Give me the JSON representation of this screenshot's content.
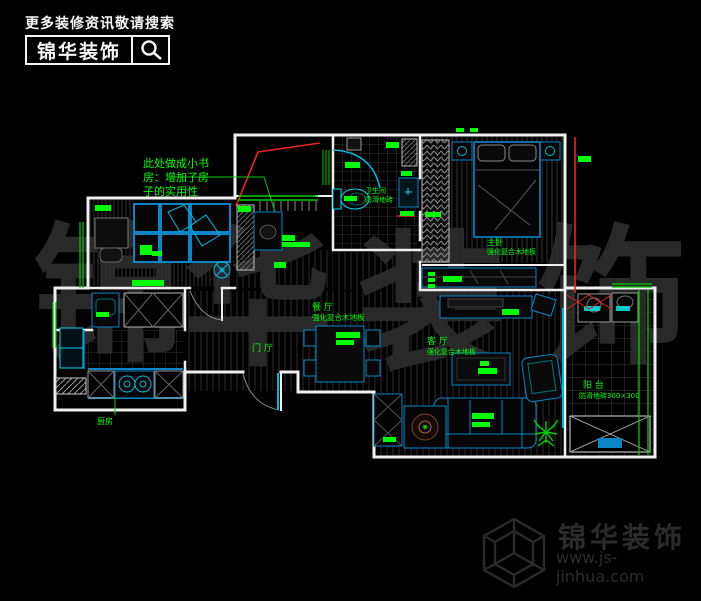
{
  "header": {
    "tagline": "更多装修资讯敬请搜索",
    "brand": "锦华装饰",
    "search_icon": "magnifier-icon"
  },
  "note": {
    "lines": [
      "此处做成小书",
      "房：增加了房",
      "子的实用性"
    ]
  },
  "labels": {
    "dining_name": "餐 厅",
    "dining_floor": "强化复合木地板",
    "foyer_name": "门 厅",
    "living_name": "客 厅",
    "living_floor": "强化复合木地板",
    "master_name": "主卧",
    "master_floor": "强化复合木地板",
    "bedroom2_floor": "强化复合木地板",
    "bath_name": "卫生间",
    "bath_floor": "防滑地砖",
    "balcony_name": "阳 台",
    "balcony_floor": "防滑地砖300×300",
    "kitchen_name": "厨房"
  },
  "watermark": {
    "chars": [
      "锦",
      "华",
      "装",
      "饰"
    ]
  },
  "footer": {
    "brand": "锦华装饰",
    "url": "www.js-jinhua.com",
    "icon": "cube-logo"
  },
  "colors": {
    "background": "#000000",
    "wall": "#f0f0f0",
    "furniture_blue": "#0a86c8",
    "cyan": "#00e5ff",
    "label_green": "#00ff00",
    "accent_red": "#ff2222",
    "watermark_gray": "#2d2d2d",
    "hatch_gray": "#2f2f2f"
  }
}
